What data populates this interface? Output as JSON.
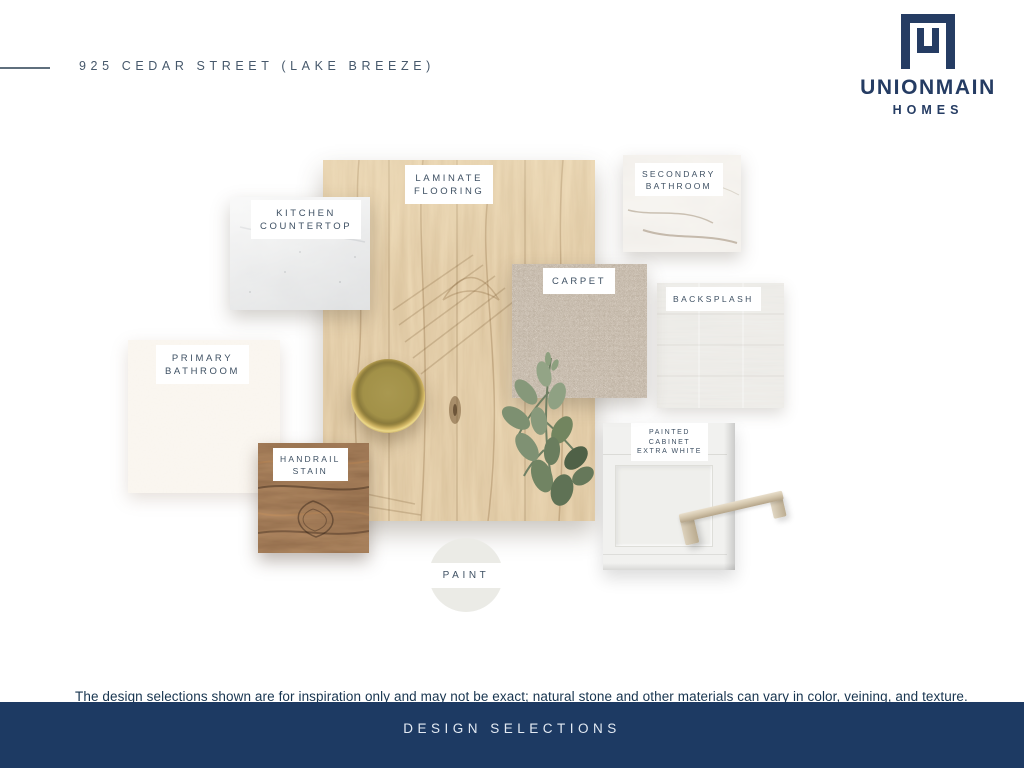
{
  "header": {
    "title": "925 CEDAR STREET (LAKE BREEZE)",
    "brand_name": "UNIONMAIN",
    "brand_sub": "HOMES"
  },
  "swatches": {
    "laminate_flooring": {
      "line1": "LAMINATE",
      "line2": "FLOORING"
    },
    "kitchen_countertop": {
      "line1": "KITCHEN",
      "line2": "COUNTERTOP"
    },
    "secondary_bathroom": {
      "line1": "SECONDARY",
      "line2": "BATHROOM"
    },
    "carpet": {
      "line1": "CARPET"
    },
    "backsplash": {
      "line1": "BACKSPLASH"
    },
    "primary_bathroom": {
      "line1": "PRIMARY",
      "line2": "BATHROOM"
    },
    "handrail_stain": {
      "line1": "HANDRAIL",
      "line2": "STAIN"
    },
    "painted_cabinet": {
      "line1": "PAINTED",
      "line2": "CABINET",
      "line3": "EXTRA WHITE"
    },
    "paint": {
      "line1": "PAINT"
    }
  },
  "footer": {
    "disclaimer": "The design selections shown are for inspiration only and may not be exact; natural stone and other materials can vary in color, veining, and texture.",
    "banner": "DESIGN SELECTIONS"
  },
  "colors": {
    "brand_navy": "#253c63",
    "banner_navy": "#1d3a63",
    "label_text": "#3e5063",
    "title_text": "#46586b",
    "wood_tan": "#c9a368",
    "handrail_brown": "#5e3a22",
    "carpet_beige": "#b5a694",
    "primary_cream": "#f6ede1",
    "paint_swatch": "#ebebe6",
    "handle_champagne": "#d0c2a8",
    "tray_brass": "#a29148"
  }
}
